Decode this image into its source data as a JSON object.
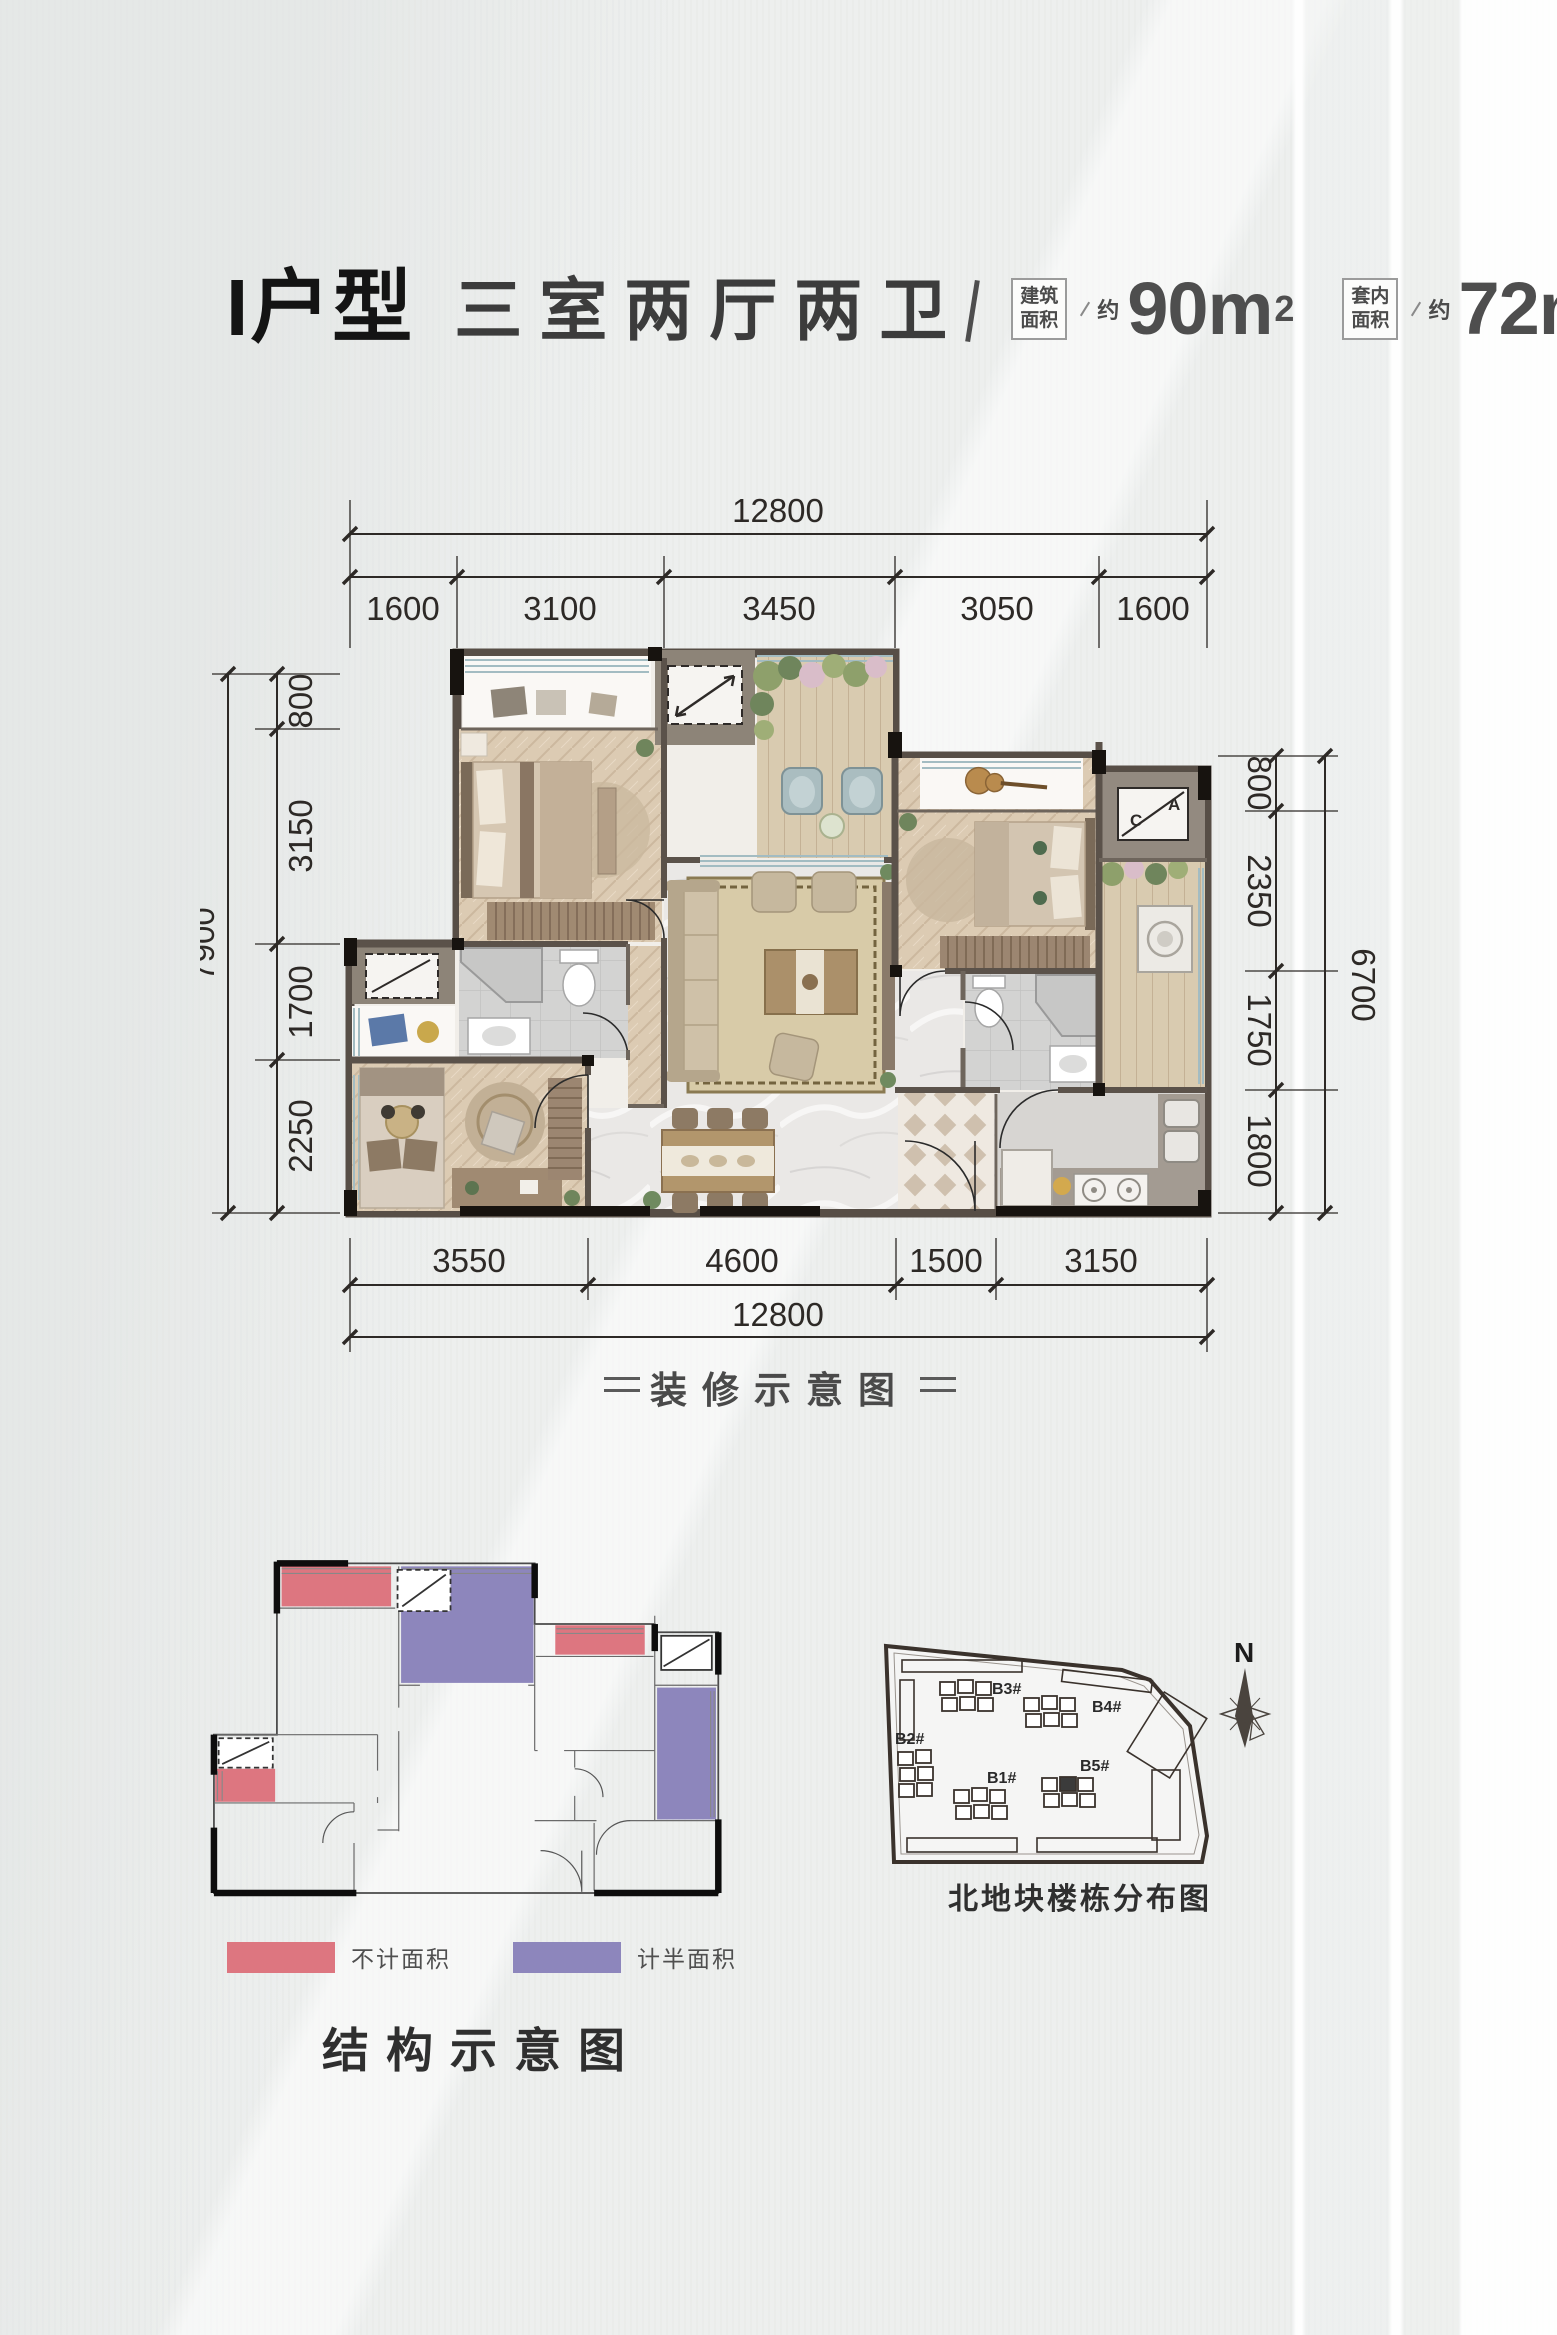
{
  "header": {
    "unit_type": "I户型",
    "rooms_desc": "三室两厅两卫",
    "areas": [
      {
        "label_line1": "建筑",
        "label_line2": "面积",
        "approx": "约",
        "value": "90m",
        "sup": "2"
      },
      {
        "label_line1": "套内",
        "label_line2": "面积",
        "approx": "约",
        "value": "72m",
        "sup": "2"
      }
    ]
  },
  "decor_plan": {
    "caption": "装修示意图",
    "dims": {
      "top": {
        "total": "12800",
        "segments": [
          "1600",
          "3100",
          "3450",
          "3050",
          "1600"
        ]
      },
      "bottom": {
        "total": "12800",
        "segments": [
          "3550",
          "4600",
          "1500",
          "3150"
        ]
      },
      "left": {
        "total": "7900",
        "segments": [
          "800",
          "3150",
          "1700",
          "2250"
        ]
      },
      "right": {
        "total": "6700",
        "segments": [
          "800",
          "2350",
          "1750",
          "1800"
        ]
      }
    },
    "ac_labels": {
      "c": "C",
      "a": "A"
    }
  },
  "structure_plan": {
    "caption": "结构示意图",
    "legend": [
      {
        "label": "不计面积",
        "color": "#dd7680"
      },
      {
        "label": "计半面积",
        "color": "#8d86bc"
      }
    ]
  },
  "site_plan": {
    "caption": "北地块楼栋分布图",
    "north_label": "N",
    "buildings": [
      {
        "id": "B1#"
      },
      {
        "id": "B2#"
      },
      {
        "id": "B3#"
      },
      {
        "id": "B4#"
      },
      {
        "id": "B5#"
      }
    ],
    "highlighted_building": "B5#"
  }
}
